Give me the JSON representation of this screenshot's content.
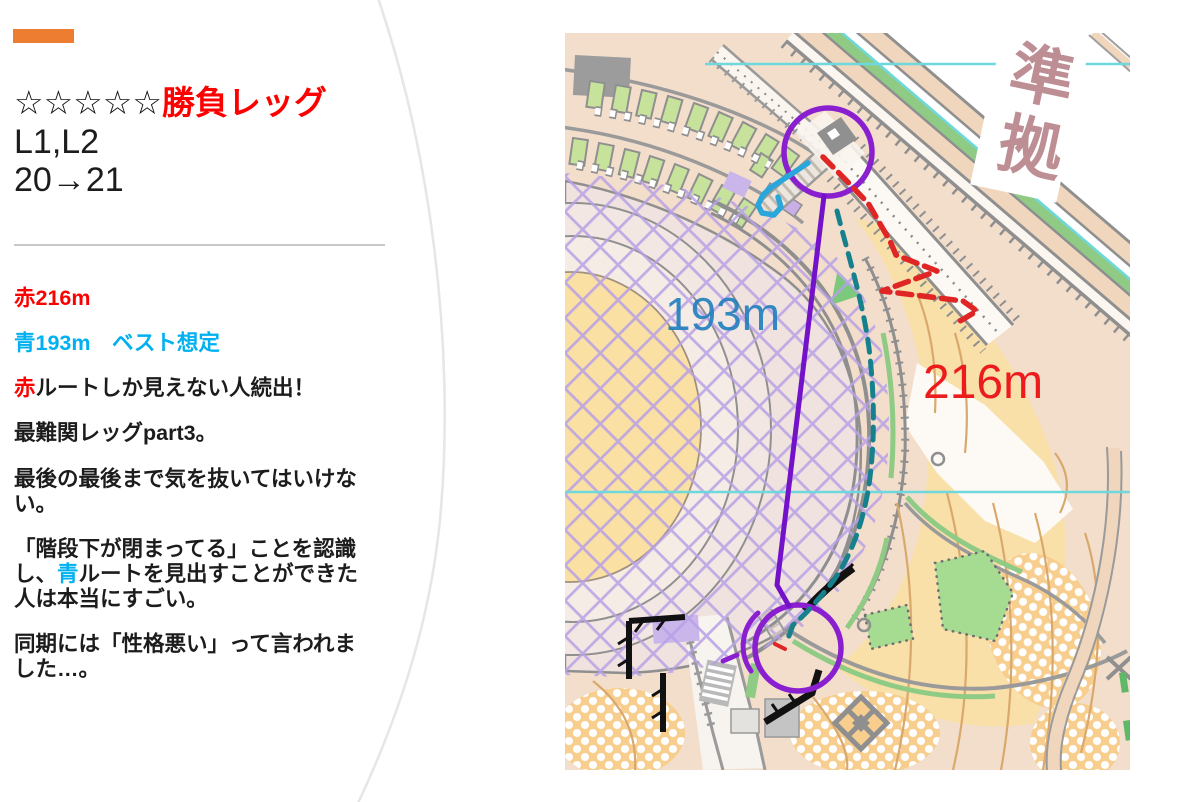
{
  "slide": {
    "accent_color": "#ED7D31",
    "title": {
      "stars": "☆☆☆☆☆",
      "emphasis": "勝負レッグ",
      "line2": "L1,L2",
      "line3": "20→21"
    },
    "notes": {
      "red_distance": "赤216m",
      "blue_distance": "青193m　ベスト想定",
      "p1_red": "赤",
      "p1_rest": "ルートしか見えない人続出！",
      "p2": "最難関レッグpart3。",
      "p3": "最後の最後まで気を抜いてはいけない。",
      "p4_pre": "「階段下が閉まってる」ことを認識し、",
      "p4_blue": "青",
      "p4_post": "ルートを見出すことができた人は本当にすごい。",
      "p5": "同期には「性格悪い」って言われました…。"
    },
    "text_colors": {
      "red": "#FF0000",
      "blue": "#00B0F0"
    }
  },
  "map": {
    "blue_route_label": "193m",
    "red_route_label": "216m",
    "corner_text_1": "準",
    "corner_text_2": "拠",
    "label_colors": {
      "blue_label": "#1F7EBE",
      "red_label": "#ED1C1C"
    },
    "route_colors": {
      "leg_line": "#7412C9",
      "control_circle": "#8A1FD0",
      "best_route_solid": "#2AA6DB",
      "blue_route_dashed": "#16808C",
      "red_route_dashed": "#E02525"
    }
  }
}
